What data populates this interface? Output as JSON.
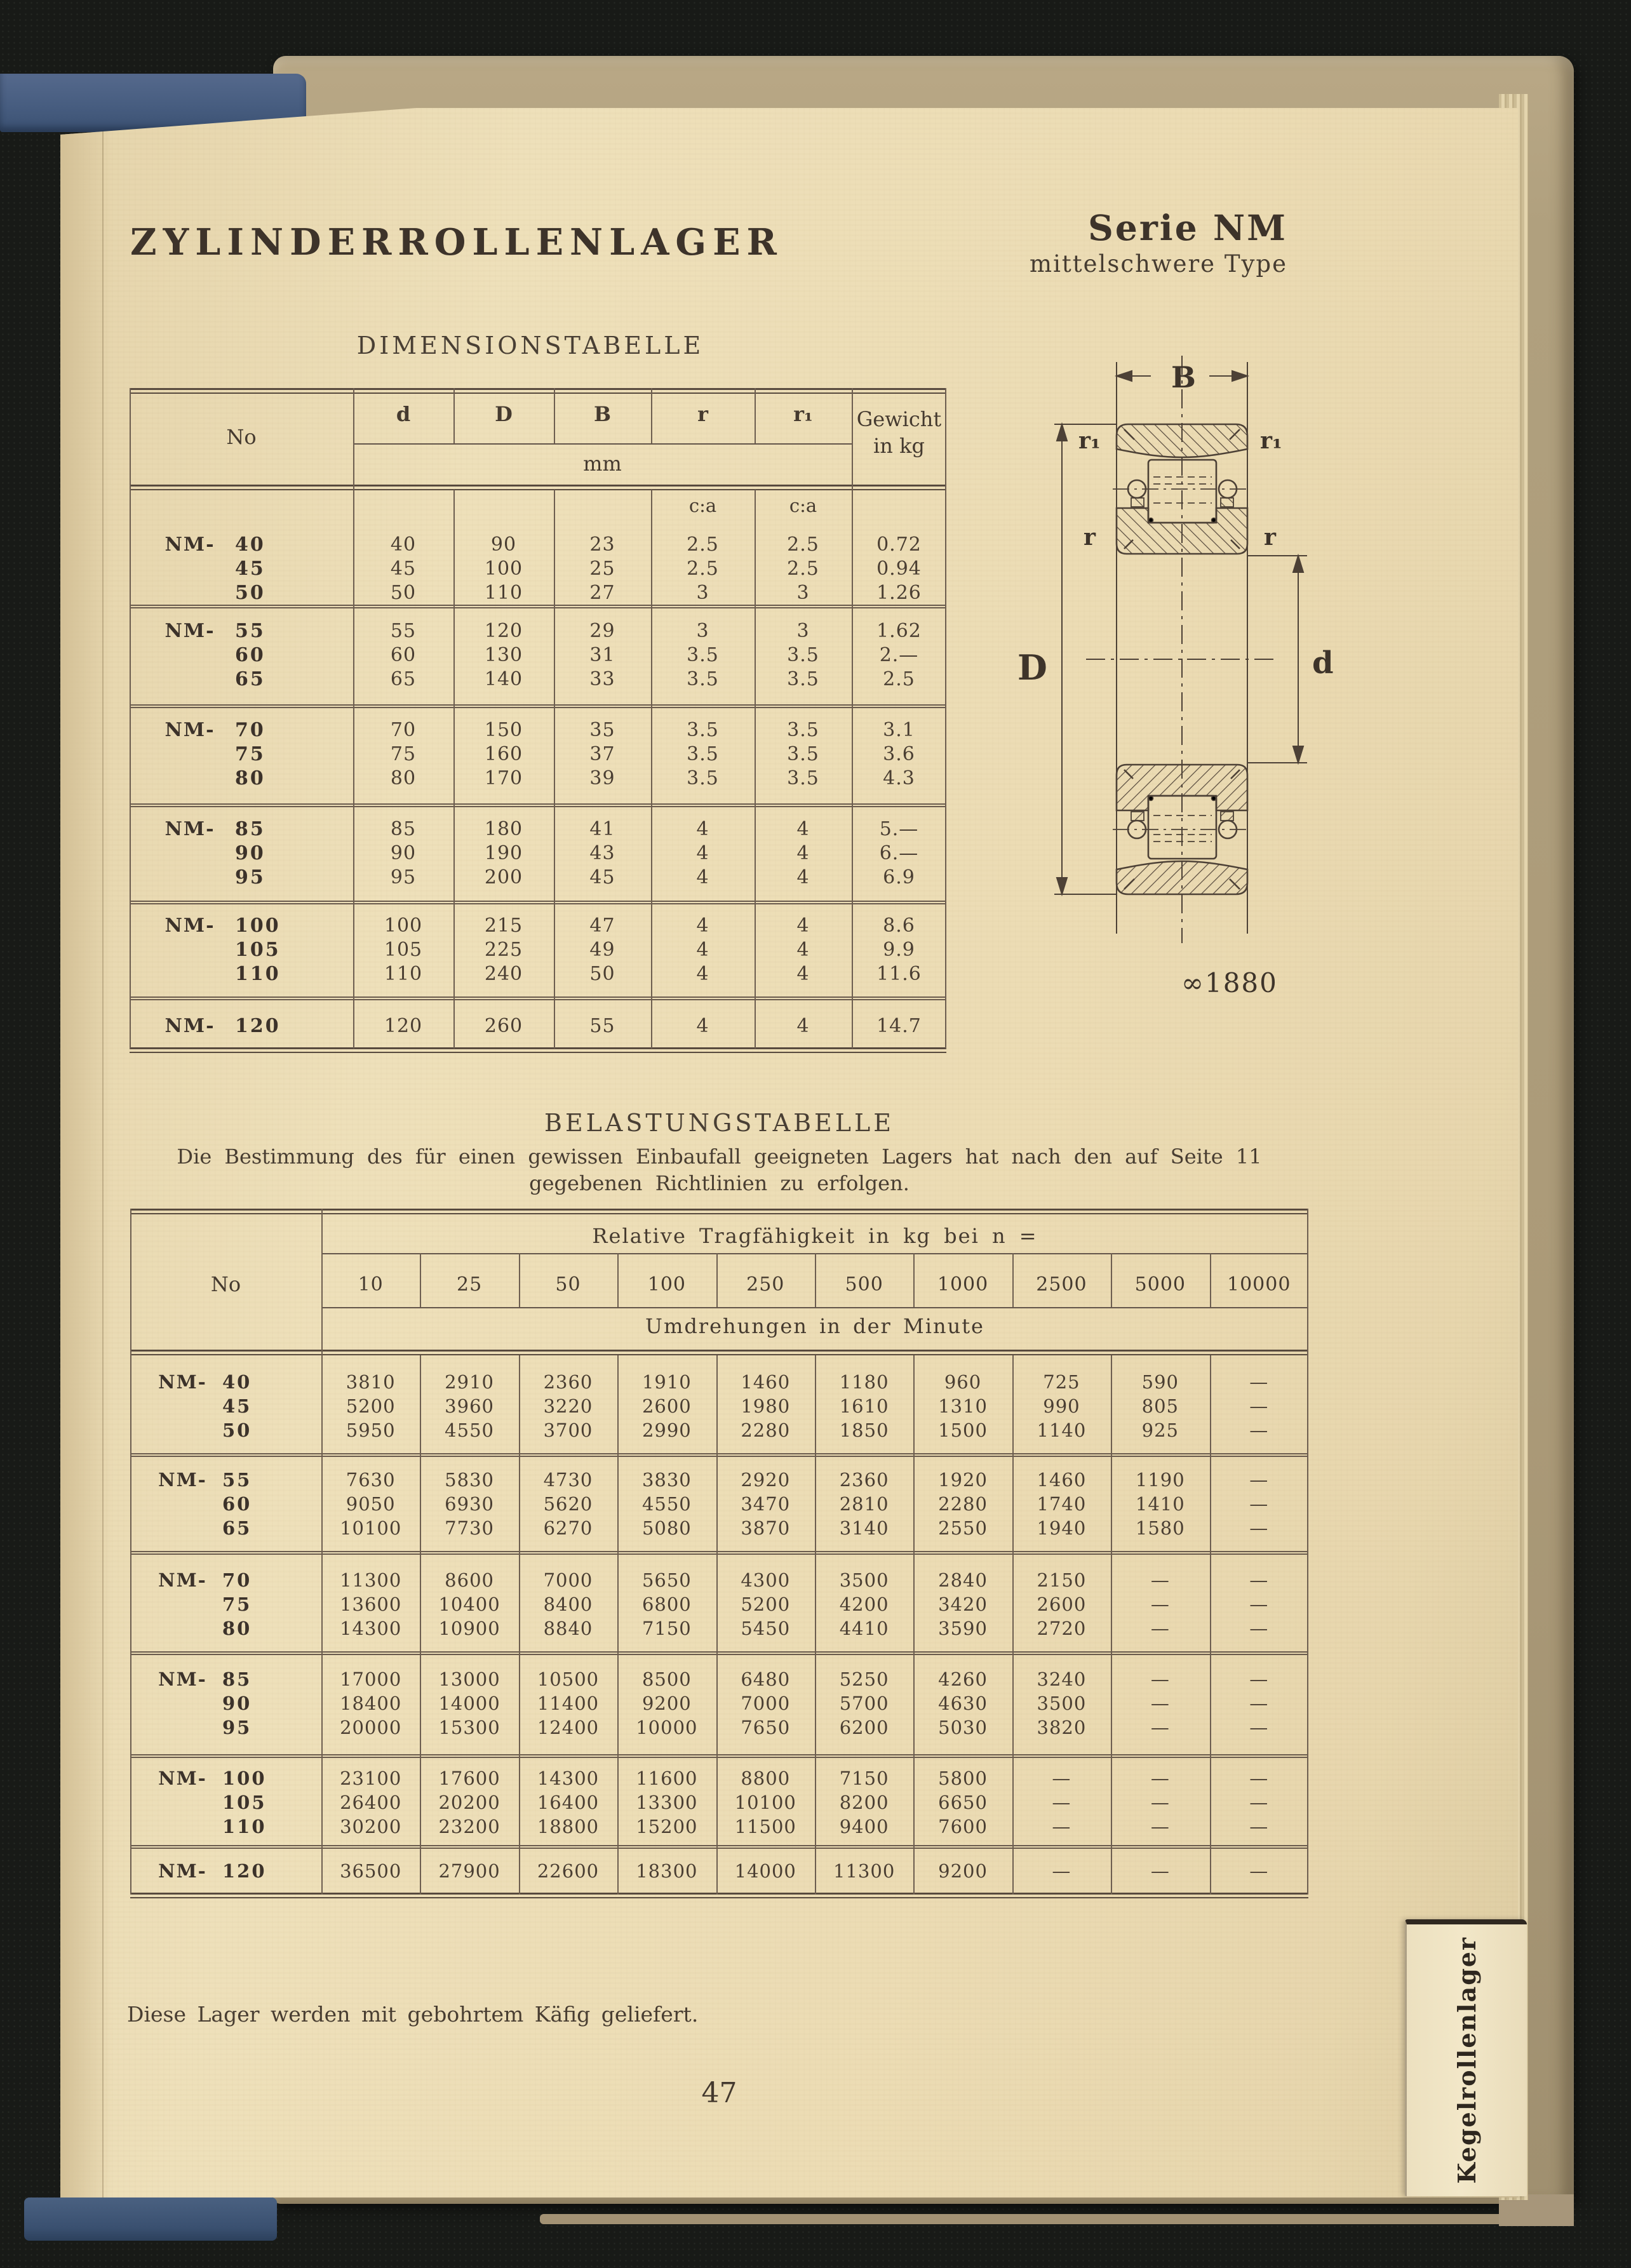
{
  "scan": {
    "title": "ZYLINDERROLLENLAGER",
    "series": "Serie NM",
    "series_subtitle": "mittelschwere Type",
    "footer_note": "Diese Lager werden mit gebohrtem Käfig geliefert.",
    "page_number": "47",
    "side_tab_label": "Kegelrollenlager",
    "figure_ref": "∞1880"
  },
  "dimension_table": {
    "title": "DIMENSIONSTABELLE",
    "no_header": "No",
    "dim_headers": [
      "d",
      "D",
      "B",
      "r",
      "r₁"
    ],
    "unit_label": "mm",
    "weight_header_line1": "Gewicht",
    "weight_header_line2": "in kg",
    "ca_label": "c:a",
    "groups": [
      {
        "rows": [
          {
            "prefix": "NM-",
            "no": "40",
            "d": "40",
            "D": "90",
            "B": "23",
            "r": "2.5",
            "r1": "2.5",
            "wt": "0.72"
          },
          {
            "prefix": "",
            "no": "45",
            "d": "45",
            "D": "100",
            "B": "25",
            "r": "2.5",
            "r1": "2.5",
            "wt": "0.94"
          },
          {
            "prefix": "",
            "no": "50",
            "d": "50",
            "D": "110",
            "B": "27",
            "r": "3",
            "r1": "3",
            "wt": "1.26"
          }
        ]
      },
      {
        "rows": [
          {
            "prefix": "NM-",
            "no": "55",
            "d": "55",
            "D": "120",
            "B": "29",
            "r": "3",
            "r1": "3",
            "wt": "1.62"
          },
          {
            "prefix": "",
            "no": "60",
            "d": "60",
            "D": "130",
            "B": "31",
            "r": "3.5",
            "r1": "3.5",
            "wt": "2.—"
          },
          {
            "prefix": "",
            "no": "65",
            "d": "65",
            "D": "140",
            "B": "33",
            "r": "3.5",
            "r1": "3.5",
            "wt": "2.5"
          }
        ]
      },
      {
        "rows": [
          {
            "prefix": "NM-",
            "no": "70",
            "d": "70",
            "D": "150",
            "B": "35",
            "r": "3.5",
            "r1": "3.5",
            "wt": "3.1"
          },
          {
            "prefix": "",
            "no": "75",
            "d": "75",
            "D": "160",
            "B": "37",
            "r": "3.5",
            "r1": "3.5",
            "wt": "3.6"
          },
          {
            "prefix": "",
            "no": "80",
            "d": "80",
            "D": "170",
            "B": "39",
            "r": "3.5",
            "r1": "3.5",
            "wt": "4.3"
          }
        ]
      },
      {
        "rows": [
          {
            "prefix": "NM-",
            "no": "85",
            "d": "85",
            "D": "180",
            "B": "41",
            "r": "4",
            "r1": "4",
            "wt": "5.—"
          },
          {
            "prefix": "",
            "no": "90",
            "d": "90",
            "D": "190",
            "B": "43",
            "r": "4",
            "r1": "4",
            "wt": "6.—"
          },
          {
            "prefix": "",
            "no": "95",
            "d": "95",
            "D": "200",
            "B": "45",
            "r": "4",
            "r1": "4",
            "wt": "6.9"
          }
        ]
      },
      {
        "rows": [
          {
            "prefix": "NM-",
            "no": "100",
            "d": "100",
            "D": "215",
            "B": "47",
            "r": "4",
            "r1": "4",
            "wt": "8.6"
          },
          {
            "prefix": "",
            "no": "105",
            "d": "105",
            "D": "225",
            "B": "49",
            "r": "4",
            "r1": "4",
            "wt": "9.9"
          },
          {
            "prefix": "",
            "no": "110",
            "d": "110",
            "D": "240",
            "B": "50",
            "r": "4",
            "r1": "4",
            "wt": "11.6"
          }
        ]
      },
      {
        "rows": [
          {
            "prefix": "NM-",
            "no": "120",
            "d": "120",
            "D": "260",
            "B": "55",
            "r": "4",
            "r1": "4",
            "wt": "14.7"
          }
        ]
      }
    ]
  },
  "load_table": {
    "title": "BELASTUNGSTABELLE",
    "intro_line1": "Die Bestimmung des für einen gewissen Einbaufall geeigneten Lagers hat nach den auf Seite 11",
    "intro_line2": "gegebenen Richtlinien zu erfolgen.",
    "no_header": "No",
    "span_header": "Relative Tragfähigkeit in kg bei n =",
    "speed_headers": [
      "10",
      "25",
      "50",
      "100",
      "250",
      "500",
      "1000",
      "2500",
      "5000",
      "10000"
    ],
    "sub_header": "Umdrehungen in der Minute",
    "groups": [
      {
        "rows": [
          {
            "prefix": "NM-",
            "no": "40",
            "vals": [
              "3810",
              "2910",
              "2360",
              "1910",
              "1460",
              "1180",
              "960",
              "725",
              "590",
              "—"
            ]
          },
          {
            "prefix": "",
            "no": "45",
            "vals": [
              "5200",
              "3960",
              "3220",
              "2600",
              "1980",
              "1610",
              "1310",
              "990",
              "805",
              "—"
            ]
          },
          {
            "prefix": "",
            "no": "50",
            "vals": [
              "5950",
              "4550",
              "3700",
              "2990",
              "2280",
              "1850",
              "1500",
              "1140",
              "925",
              "—"
            ]
          }
        ]
      },
      {
        "rows": [
          {
            "prefix": "NM-",
            "no": "55",
            "vals": [
              "7630",
              "5830",
              "4730",
              "3830",
              "2920",
              "2360",
              "1920",
              "1460",
              "1190",
              "—"
            ]
          },
          {
            "prefix": "",
            "no": "60",
            "vals": [
              "9050",
              "6930",
              "5620",
              "4550",
              "3470",
              "2810",
              "2280",
              "1740",
              "1410",
              "—"
            ]
          },
          {
            "prefix": "",
            "no": "65",
            "vals": [
              "10100",
              "7730",
              "6270",
              "5080",
              "3870",
              "3140",
              "2550",
              "1940",
              "1580",
              "—"
            ]
          }
        ]
      },
      {
        "rows": [
          {
            "prefix": "NM-",
            "no": "70",
            "vals": [
              "11300",
              "8600",
              "7000",
              "5650",
              "4300",
              "3500",
              "2840",
              "2150",
              "—",
              "—"
            ]
          },
          {
            "prefix": "",
            "no": "75",
            "vals": [
              "13600",
              "10400",
              "8400",
              "6800",
              "5200",
              "4200",
              "3420",
              "2600",
              "—",
              "—"
            ]
          },
          {
            "prefix": "",
            "no": "80",
            "vals": [
              "14300",
              "10900",
              "8840",
              "7150",
              "5450",
              "4410",
              "3590",
              "2720",
              "—",
              "—"
            ]
          }
        ]
      },
      {
        "rows": [
          {
            "prefix": "NM-",
            "no": "85",
            "vals": [
              "17000",
              "13000",
              "10500",
              "8500",
              "6480",
              "5250",
              "4260",
              "3240",
              "—",
              "—"
            ]
          },
          {
            "prefix": "",
            "no": "90",
            "vals": [
              "18400",
              "14000",
              "11400",
              "9200",
              "7000",
              "5700",
              "4630",
              "3500",
              "—",
              "—"
            ]
          },
          {
            "prefix": "",
            "no": "95",
            "vals": [
              "20000",
              "15300",
              "12400",
              "10000",
              "7650",
              "6200",
              "5030",
              "3820",
              "—",
              "—"
            ]
          }
        ]
      },
      {
        "rows": [
          {
            "prefix": "NM-",
            "no": "100",
            "vals": [
              "23100",
              "17600",
              "14300",
              "11600",
              "8800",
              "7150",
              "5800",
              "—",
              "—",
              "—"
            ]
          },
          {
            "prefix": "",
            "no": "105",
            "vals": [
              "26400",
              "20200",
              "16400",
              "13300",
              "10100",
              "8200",
              "6650",
              "—",
              "—",
              "—"
            ]
          },
          {
            "prefix": "",
            "no": "110",
            "vals": [
              "30200",
              "23200",
              "18800",
              "15200",
              "11500",
              "9400",
              "7600",
              "—",
              "—",
              "—"
            ]
          }
        ]
      },
      {
        "rows": [
          {
            "prefix": "NM-",
            "no": "120",
            "vals": [
              "36500",
              "27900",
              "22600",
              "18300",
              "14000",
              "11300",
              "9200",
              "—",
              "—",
              "—"
            ]
          }
        ]
      }
    ]
  },
  "drawing": {
    "label_b": "B",
    "label_outer_diameter": "D",
    "label_bore": "d",
    "label_r_left": "r",
    "label_r_right": "r",
    "label_r1_left": "r₁",
    "label_r1_right": "r₁",
    "figure_ref": "∞1880"
  }
}
